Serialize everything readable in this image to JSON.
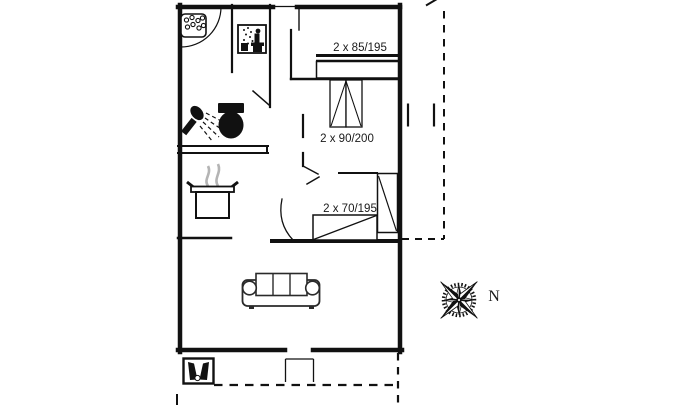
{
  "floorplan": {
    "bed_labels": {
      "double_bed": "2 x 85/195",
      "twin_beds": "2 x 90/200",
      "bunk_bed": "2 x 70/195"
    },
    "compass": {
      "north": "N"
    },
    "colors": {
      "background": "#ffffff",
      "wall": "#111111",
      "fixture": "#111111",
      "steam_gray": "#b4b4b4",
      "sofa_line": "#2a2a2a",
      "text": "#1a1a1a"
    },
    "icons": {
      "spa": "spa-bath-icon",
      "sauna": "sauna-icon",
      "shower": "shower-icon",
      "toilet": "toilet-icon",
      "cooking_pot": "cooking-pot-icon",
      "wood_stove": "wood-stove-icon",
      "sofa": "sofa-icon",
      "compass_rose": "compass-rose-icon"
    }
  }
}
